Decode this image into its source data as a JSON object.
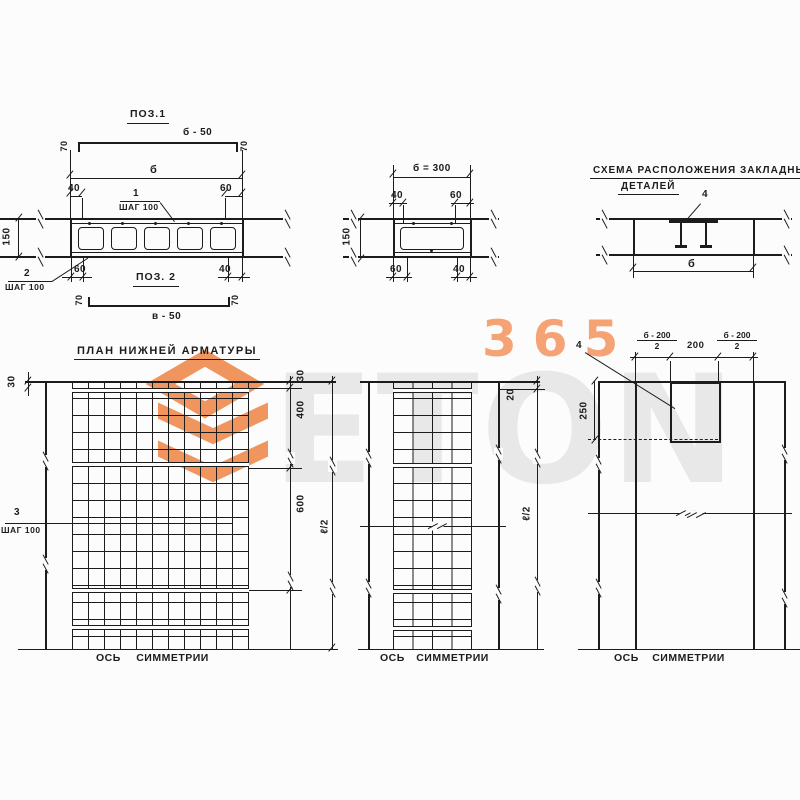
{
  "watermark": {
    "brand": "ETON",
    "number": "365"
  },
  "poz1": {
    "title": "ПОЗ.1",
    "length": "б - 50",
    "hook": "70",
    "dim_overall": "б",
    "dim_40": "40",
    "dim_60": "60",
    "pos_no": "1",
    "step": "ШАГ 100"
  },
  "sec1": {
    "height": "150",
    "pos_no": "2",
    "step": "ШАГ 100",
    "dim_60": "60",
    "dim_40": "40"
  },
  "poz2": {
    "title": "ПОЗ. 2",
    "length": "в - 50",
    "hook": "70"
  },
  "sec2": {
    "width": "б = 300",
    "top_40": "40",
    "top_60": "60",
    "height": "150",
    "bot_60": "60",
    "bot_40": "40"
  },
  "scheme": {
    "title1": "СХЕМА РАСПОЛОЖЕНИЯ ЗАКЛАДНЫХ",
    "title2": "ДЕТАЛЕЙ",
    "pos_no": "4",
    "dim": "б"
  },
  "plan1": {
    "title": "ПЛАН НИЖНЕЙ АРМАТУРЫ",
    "dim_30l": "30",
    "dim_30r": "30",
    "dim_400": "400",
    "dim_600": "600",
    "dim_half": "ℓ/2",
    "pos_no": "3",
    "step": "ШАГ 100",
    "axis": "ОСЬ СИММЕТРИИ"
  },
  "plan2": {
    "dim_20": "20",
    "dim_half": "ℓ/2",
    "axis": "ОСЬ СИММЕТРИИ"
  },
  "plan3": {
    "pos_no": "4",
    "frac_top": "б - 200",
    "frac_bot": "2",
    "dim_200": "200",
    "dim_250": "250",
    "axis": "ОСЬ СИММЕТРИИ"
  }
}
